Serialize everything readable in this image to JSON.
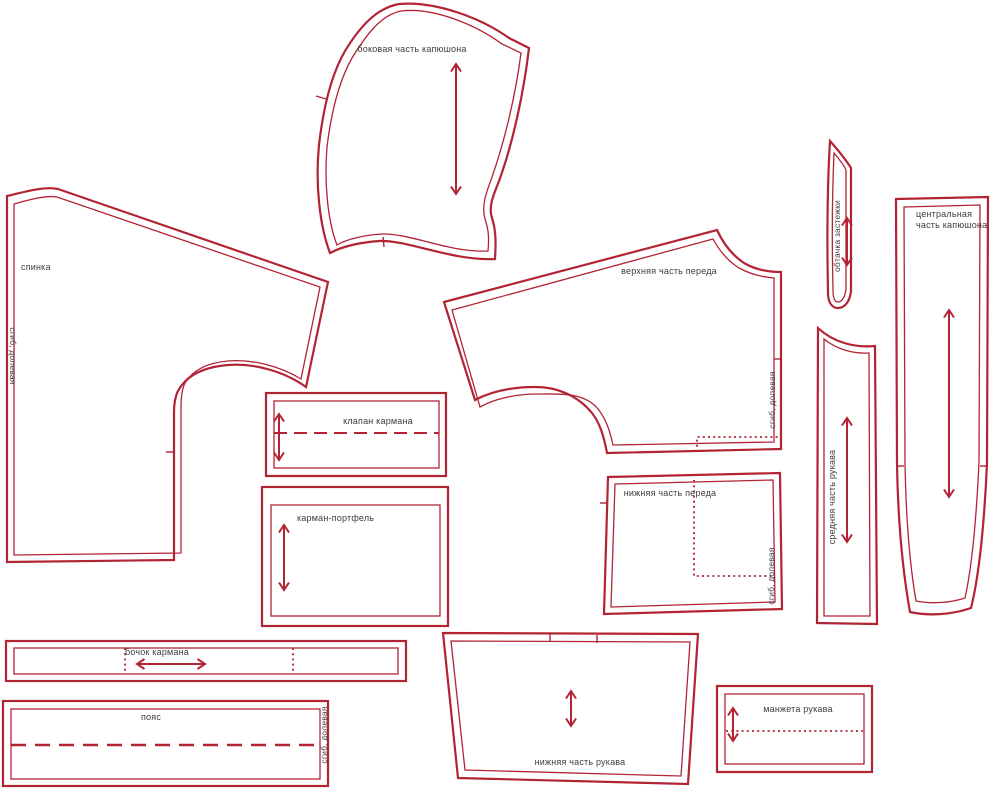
{
  "diagram": {
    "type": "sewing-pattern-layout",
    "outline_color": "#b22334",
    "label_color": "#3c3c3c",
    "background": "#ffffff"
  },
  "pieces": [
    {
      "id": "hood-side",
      "label": "боковая часть капюшона",
      "grain_arrow": "vertical"
    },
    {
      "id": "back",
      "label": "спинка",
      "grain_note": "сгиб, долевая",
      "grain_arrow": null
    },
    {
      "id": "upper-front",
      "label": "верхняя часть переда",
      "grain_note": "сгиб, долевая",
      "grain_arrow": null
    },
    {
      "id": "fastening-facing",
      "label": "обтачка застежки",
      "grain_arrow": "vertical"
    },
    {
      "id": "hood-center",
      "label": "центральная часть капюшона",
      "grain_arrow": "vertical"
    },
    {
      "id": "pocket-flap",
      "label": "клапан кармана",
      "grain_arrow": "vertical"
    },
    {
      "id": "pocket-portfolio",
      "label": "карман-портфель",
      "grain_arrow": "vertical"
    },
    {
      "id": "lower-front",
      "label": "нижняя часть переда",
      "grain_note": "сгиб, долевая",
      "grain_arrow": null
    },
    {
      "id": "sleeve-middle",
      "label": "средняя часть рукава",
      "grain_arrow": "vertical"
    },
    {
      "id": "pocket-side",
      "label": "бочок кармана",
      "grain_arrow": "horizontal"
    },
    {
      "id": "belt",
      "label": "пояс",
      "grain_note": "сгиб, долевая",
      "grain_arrow": null
    },
    {
      "id": "sleeve-lower",
      "label": "нижняя часть рукава",
      "grain_arrow": "vertical"
    },
    {
      "id": "sleeve-cuff",
      "label": "манжета рукава",
      "grain_arrow": "vertical"
    }
  ]
}
